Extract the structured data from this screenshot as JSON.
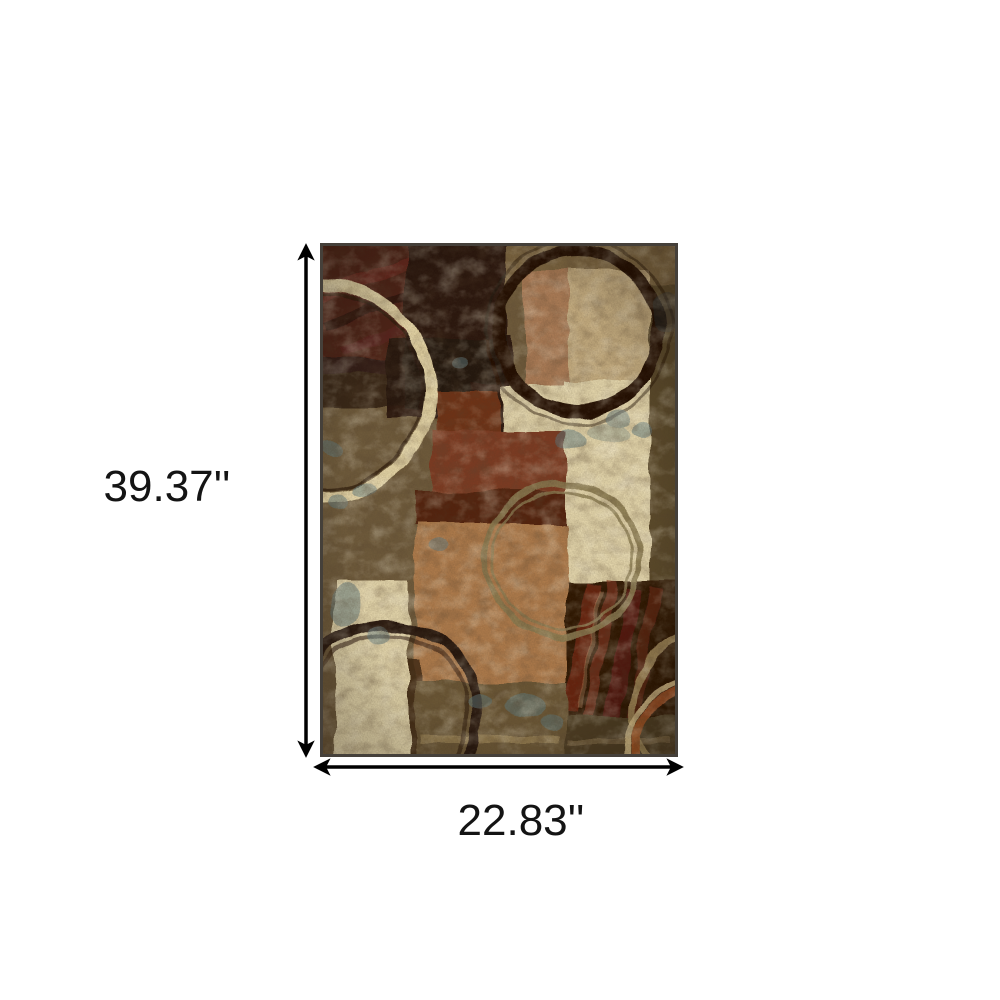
{
  "canvas": {
    "width": 1000,
    "height": 1000,
    "background": "#ffffff"
  },
  "product": {
    "name": "Abstract area rug",
    "description": "Rectangular area rug with abstract collage of color-block squares and painted circle outlines in brown, beige, rust, black and olive",
    "border_color": "#45403a",
    "palette": {
      "olive_brown": "#6e5a3a",
      "top_band": "#7b6540",
      "dark_maroon": "#4e2019",
      "near_black_brown": "#29170d",
      "tan": "#c2aa7e",
      "rust_smudge": "#a06a48",
      "cream": "#e0d2a8",
      "cream_bright": "#e2d4aa",
      "rust_red": "#7c3a22",
      "rust_dark": "#6e3018",
      "maroon_strip": "#52200f",
      "caramel": "#ad7a4c",
      "right_column": "#5a482c",
      "mahogany": "#2e1206",
      "bottom_band": "#6a5735",
      "bottom_band_dark": "#4e3d24",
      "ring_cream": "#e3d3a4",
      "ring_dark": "#201003",
      "ring_tan": "#8a7a50",
      "ring_dark_bl": "#26130a",
      "ring_sand": "#ad9560",
      "ring_rust": "#a85524",
      "blue_gray": "#5f7a80"
    }
  },
  "dimensions": {
    "height": {
      "label": "39.37''"
    },
    "width": {
      "label": "22.83''"
    },
    "arrow_color": "#000000"
  }
}
